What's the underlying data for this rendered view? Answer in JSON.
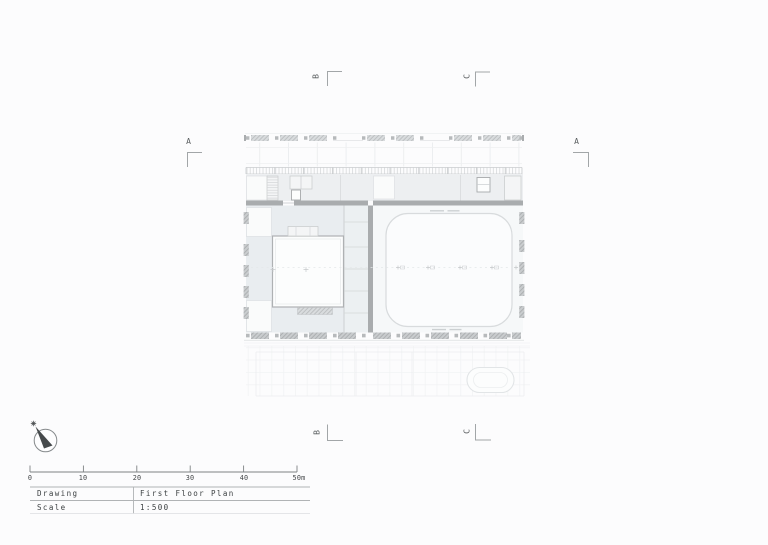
{
  "title_block": {
    "rows": [
      {
        "label": "Drawing",
        "value": "First Floor Plan"
      },
      {
        "label": "Scale",
        "value": "1:500"
      }
    ]
  },
  "scale_bar": {
    "tick_labels": [
      "0",
      "10",
      "20",
      "30",
      "40",
      "50m"
    ]
  },
  "section_markers": {
    "left": "A",
    "right": "A",
    "top_left": "B",
    "top_right": "C",
    "bottom_left": "B",
    "bottom_right": "C"
  },
  "icons": {
    "north_arrow": "north-arrow-compass"
  },
  "colors": {
    "ink": "#3c4042",
    "marker_letter": "#5a5e60",
    "line": "#a2a6a8",
    "wall": "#a9acae",
    "plan_fill": "#e9edf0",
    "faint_line": "#d8dbdd"
  }
}
